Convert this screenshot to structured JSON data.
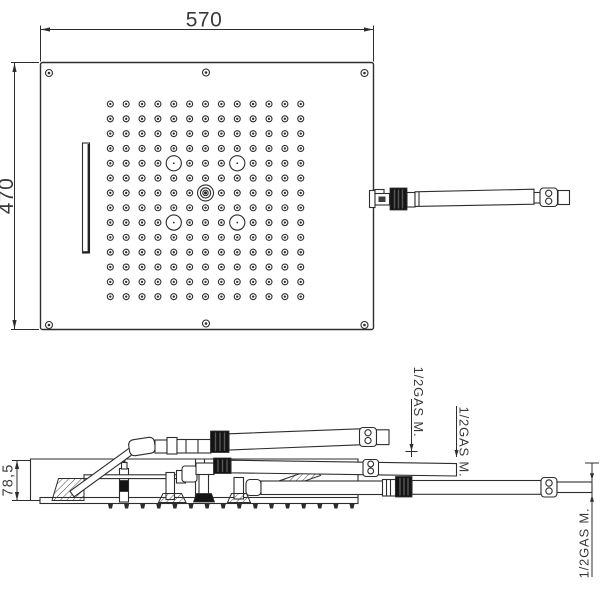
{
  "dimensions": {
    "top_width": "570",
    "top_height": "470",
    "profile_height": "78,5"
  },
  "connections": {
    "label_1": "1/2GAS M.",
    "label_2": "1/2GAS M.",
    "label_3": "1/2GAS M."
  },
  "colors": {
    "ink": "#2d2d2d",
    "black_fitting": "#141414",
    "text": "#3a3a3a",
    "paper": "#ffffff"
  },
  "nozzle_grid": {
    "rows": 14,
    "cols": 13,
    "x0": 110.3,
    "y0": 104,
    "dx": 15.87,
    "dy": 14.82,
    "nozzle_r": 3,
    "dot_r": 1.15,
    "big_jet_r": 7.6,
    "big_jets": [
      [
        4,
        4
      ],
      [
        4,
        8
      ],
      [
        8,
        4
      ],
      [
        8,
        8
      ]
    ],
    "center_jet": [
      6,
      6
    ],
    "center_rings": [
      8,
      5.1,
      2.7
    ],
    "center_dot_r": 1.6
  },
  "side_spray_ticks": {
    "count": 16,
    "x0": 110.5,
    "dx": 16.1,
    "y": 503.5
  }
}
